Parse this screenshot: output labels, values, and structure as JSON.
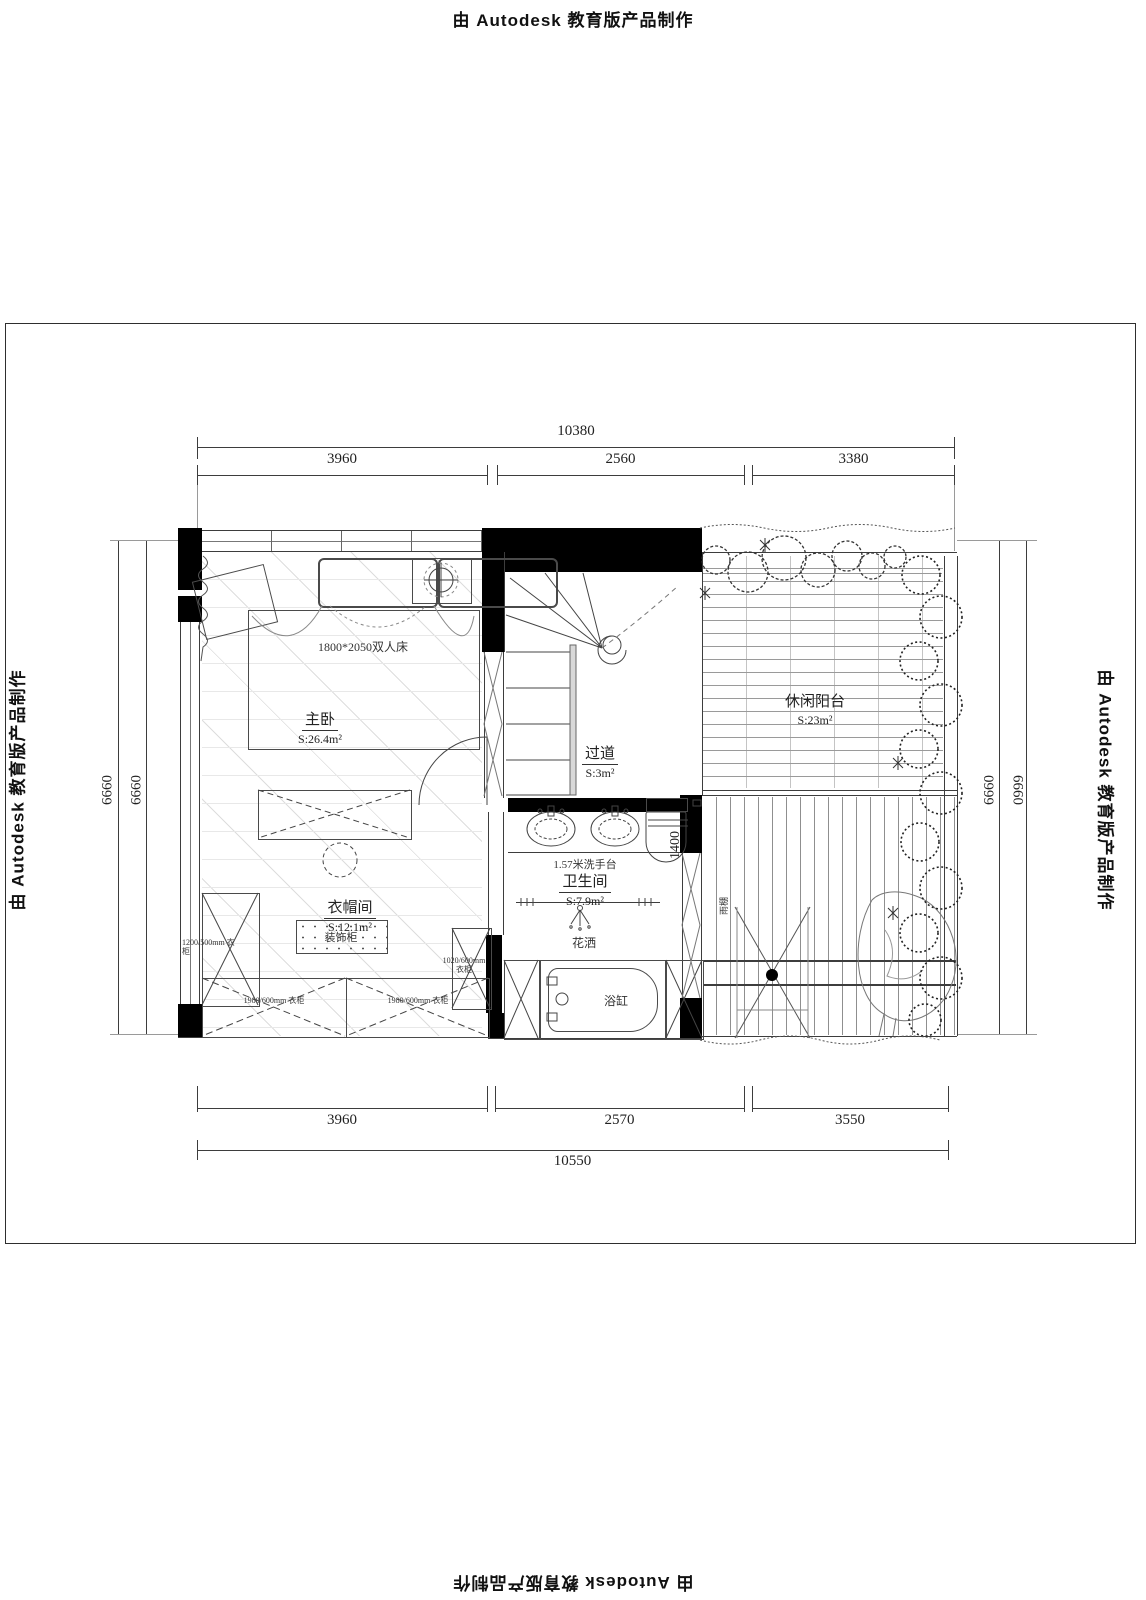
{
  "watermark": {
    "text": "由 Autodesk 教育版产品制作"
  },
  "dimensions": {
    "top": {
      "total": "10380",
      "segments": [
        "3960",
        "2560",
        "3380"
      ]
    },
    "bottom": {
      "total": "10550",
      "segments": [
        "3960",
        "2570",
        "3550"
      ]
    },
    "left": [
      "6660",
      "6660"
    ],
    "right": [
      "6660",
      "6660"
    ],
    "toilet_width": "1400"
  },
  "rooms": {
    "master_bedroom": {
      "name": "主卧",
      "area": "S:26.4m²"
    },
    "corridor": {
      "name": "过道",
      "area": "S:3m²"
    },
    "cloakroom": {
      "name": "衣帽间",
      "area": "S:12.1m²"
    },
    "bathroom": {
      "name": "卫生间",
      "area": "S:7.9m²"
    },
    "balcony": {
      "name": "休闲阳台",
      "area": "S:23m²"
    }
  },
  "furniture": {
    "bed": "1800*2050双人床",
    "decor_cabinet": "装饰柜",
    "wardrobe_left": "1200/500mm 衣柜",
    "wardrobe_right": "1020/600mm 衣柜",
    "wardrobe_bottom_left": "1980/600mm 衣柜",
    "wardrobe_bottom_right": "1980/600mm 衣柜",
    "washstand": "1.57米洗手台",
    "shower": "花洒",
    "bathtub": "浴缸",
    "canopy": "雨棚"
  }
}
